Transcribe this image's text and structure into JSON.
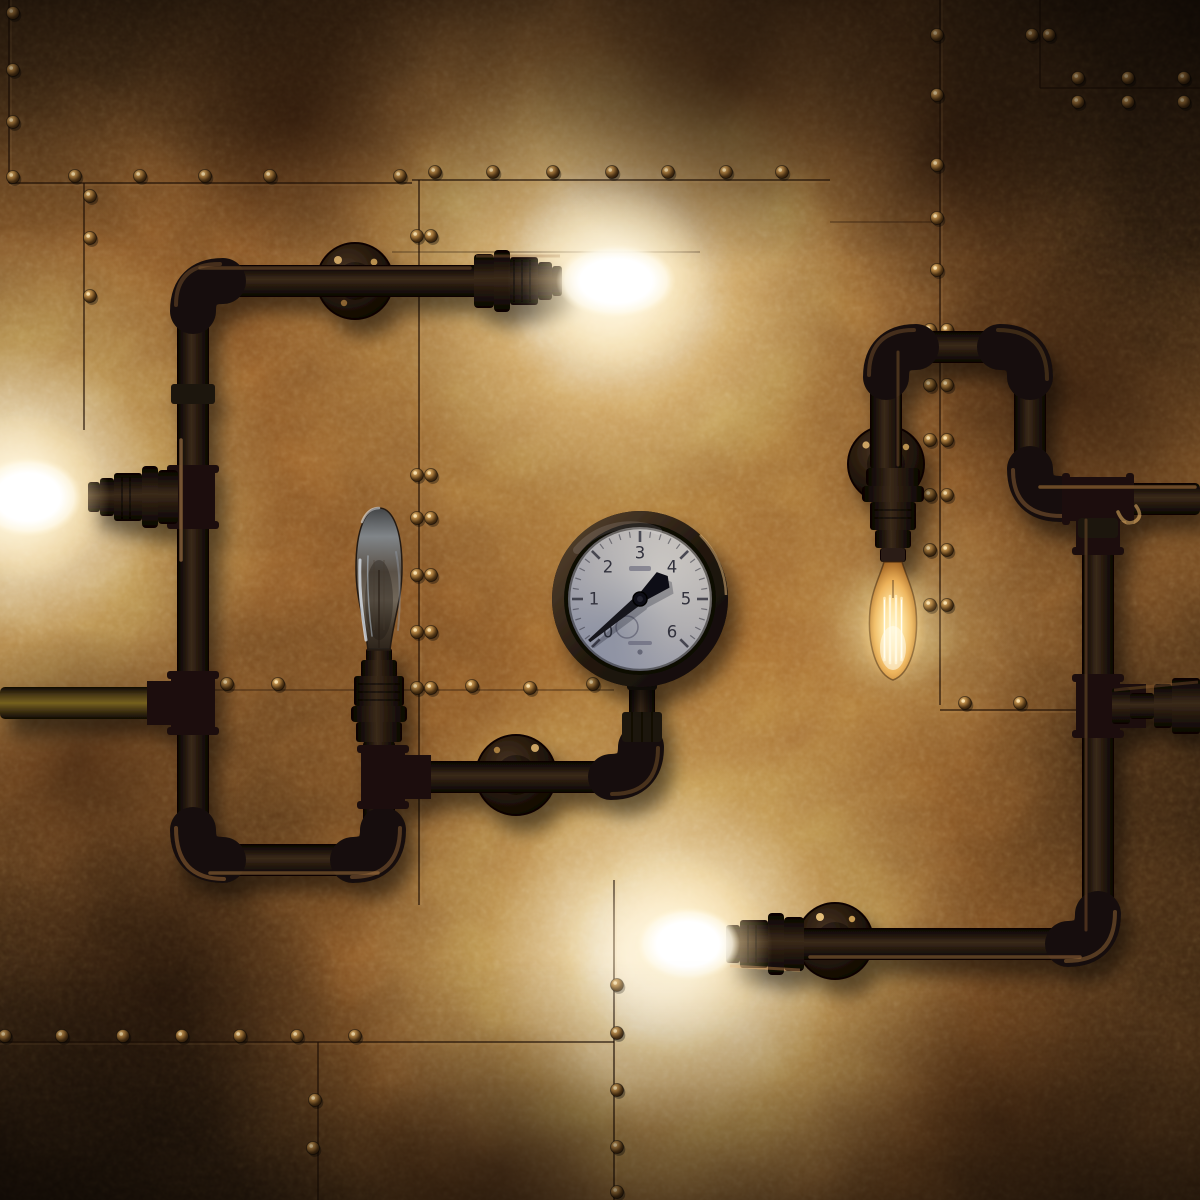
{
  "scene": {
    "type": "photograph",
    "subject": "Steampunk industrial wall lamp built from black iron pipes with Edison bulbs and a round pressure gauge, mounted on hammered copper metal panels joined by rivet seams",
    "lighting": "warm tungsten glow from four lit bulbs against dark patinated copper",
    "objects": [
      "left-pipe-network",
      "right-pipe-network",
      "pressure-gauge",
      "edison-bulb-top",
      "edison-bulb-left",
      "edison-bulb-middle-unlit",
      "edison-bulb-right-filament",
      "edison-bulb-bottom",
      "wall-mount-flanges",
      "riveted-copper-panels"
    ]
  },
  "gauge": {
    "numerals": [
      "0",
      "1",
      "2",
      "3",
      "4",
      "5",
      "6"
    ],
    "scale_min": 0,
    "scale_max": 6,
    "needle_value": 0.12,
    "face_color": "#b9b6b6",
    "needle_color": "#16161d",
    "bezel_color": "#2e2118"
  },
  "bulbs": {
    "top": "on",
    "left": "on",
    "bottom": "on",
    "right": "on",
    "middle": "off"
  },
  "palette": {
    "wall_highlight": "#f4c678",
    "wall_mid": "#8a5524",
    "wall_shadow": "#1c0f06",
    "pipe_dark": "#150d08",
    "pipe_highlight": "#3f2d1c",
    "brass_pipe": "#75601f",
    "glow_core": "#fff8e6",
    "glow_warm": "#f2a95a",
    "rivet_highlight": "#e7c17c",
    "gauge_shadow_tint": "#405484"
  }
}
